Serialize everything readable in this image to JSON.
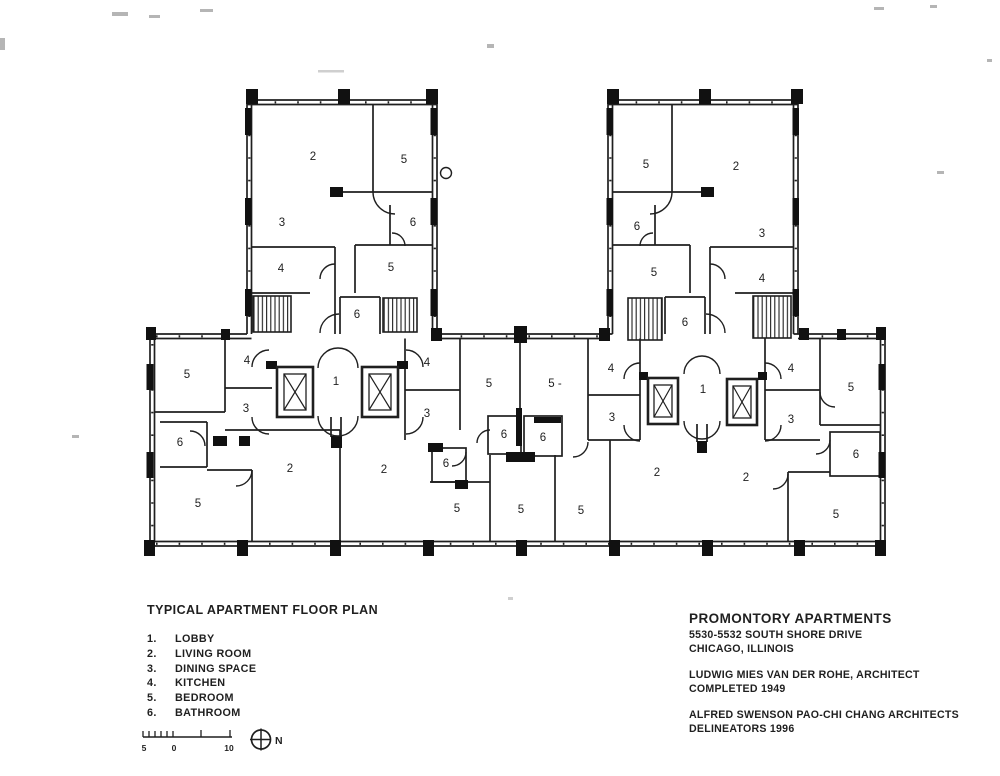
{
  "legend": {
    "title": "TYPICAL APARTMENT FLOOR PLAN",
    "items": [
      {
        "num": "1.",
        "label": "LOBBY"
      },
      {
        "num": "2.",
        "label": "LIVING ROOM"
      },
      {
        "num": "3.",
        "label": "DINING SPACE"
      },
      {
        "num": "4.",
        "label": "KITCHEN"
      },
      {
        "num": "5.",
        "label": "BEDROOM"
      },
      {
        "num": "6.",
        "label": "BATHROOM"
      }
    ]
  },
  "title_block": {
    "project": "PROMONTORY APARTMENTS",
    "address_line1": "5530-5532 SOUTH SHORE DRIVE",
    "address_line2": "CHICAGO, ILLINOIS",
    "architect_line": "LUDWIG MIES VAN DER ROHE, ARCHITECT",
    "completed_line": "COMPLETED 1949",
    "delineators_line1": "ALFRED SWENSON PAO-CHI CHANG ARCHITECTS",
    "delineators_line2": "DELINEATORS  1996"
  },
  "scale_bar": {
    "left_label": "5",
    "zero_label": "0",
    "right_label": "10"
  },
  "north": {
    "label": "N"
  },
  "colors": {
    "ink": "#1f1f1f",
    "paper": "#ffffff"
  },
  "plan": {
    "room_labels": [
      {
        "x": 313,
        "y": 156,
        "t": "2"
      },
      {
        "x": 404,
        "y": 159,
        "t": "5"
      },
      {
        "x": 282,
        "y": 222,
        "t": "3"
      },
      {
        "x": 413,
        "y": 222,
        "t": "6"
      },
      {
        "x": 281,
        "y": 268,
        "t": "4"
      },
      {
        "x": 391,
        "y": 267,
        "t": "5"
      },
      {
        "x": 357,
        "y": 314,
        "t": "6"
      },
      {
        "x": 646,
        "y": 164,
        "t": "5"
      },
      {
        "x": 736,
        "y": 166,
        "t": "2"
      },
      {
        "x": 637,
        "y": 226,
        "t": "6"
      },
      {
        "x": 762,
        "y": 233,
        "t": "3"
      },
      {
        "x": 654,
        "y": 272,
        "t": "5"
      },
      {
        "x": 762,
        "y": 278,
        "t": "4"
      },
      {
        "x": 685,
        "y": 322,
        "t": "6"
      },
      {
        "x": 187,
        "y": 374,
        "t": "5"
      },
      {
        "x": 247,
        "y": 360,
        "t": "4"
      },
      {
        "x": 246,
        "y": 408,
        "t": "3"
      },
      {
        "x": 180,
        "y": 442,
        "t": "6"
      },
      {
        "x": 198,
        "y": 503,
        "t": "5"
      },
      {
        "x": 290,
        "y": 468,
        "t": "2"
      },
      {
        "x": 336,
        "y": 381,
        "t": "1"
      },
      {
        "x": 384,
        "y": 469,
        "t": "2"
      },
      {
        "x": 427,
        "y": 362,
        "t": "4"
      },
      {
        "x": 427,
        "y": 413,
        "t": "3"
      },
      {
        "x": 489,
        "y": 383,
        "t": "5"
      },
      {
        "x": 555,
        "y": 383,
        "t": "5 -"
      },
      {
        "x": 611,
        "y": 368,
        "t": "4"
      },
      {
        "x": 612,
        "y": 417,
        "t": "3"
      },
      {
        "x": 504,
        "y": 434,
        "t": "6"
      },
      {
        "x": 543,
        "y": 437,
        "t": "6"
      },
      {
        "x": 446,
        "y": 463,
        "t": "6"
      },
      {
        "x": 457,
        "y": 508,
        "t": "5"
      },
      {
        "x": 521,
        "y": 509,
        "t": "5"
      },
      {
        "x": 581,
        "y": 510,
        "t": "5"
      },
      {
        "x": 657,
        "y": 472,
        "t": "2"
      },
      {
        "x": 703,
        "y": 389,
        "t": "1"
      },
      {
        "x": 791,
        "y": 368,
        "t": "4"
      },
      {
        "x": 851,
        "y": 387,
        "t": "5"
      },
      {
        "x": 791,
        "y": 419,
        "t": "3"
      },
      {
        "x": 856,
        "y": 454,
        "t": "6"
      },
      {
        "x": 746,
        "y": 477,
        "t": "2"
      },
      {
        "x": 836,
        "y": 514,
        "t": "5"
      }
    ]
  }
}
